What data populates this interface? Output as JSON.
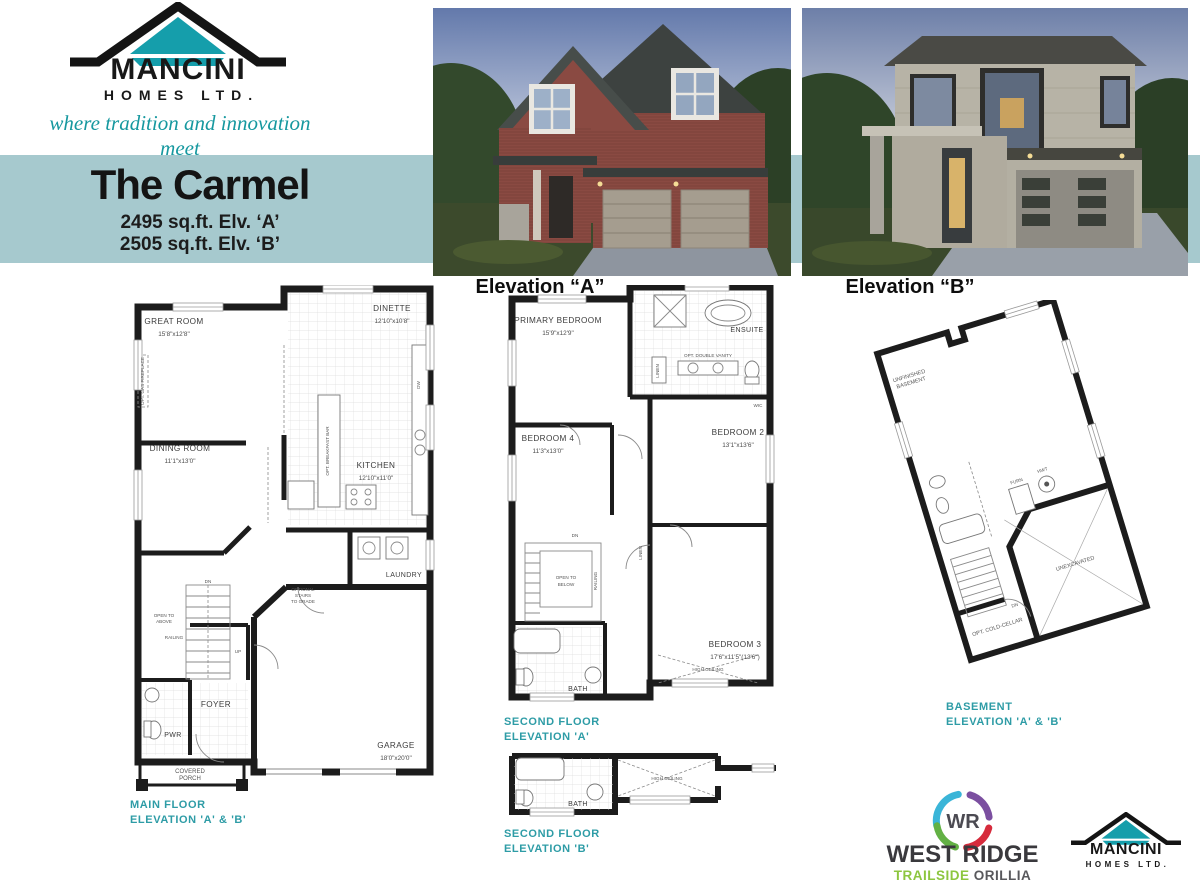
{
  "brand": {
    "name": "MANCINI",
    "suffix": "HOMES LTD.",
    "tagline": "where tradition and innovation meet"
  },
  "colors": {
    "band": "#a6c9ce",
    "accent": "#16989f",
    "caption": "#2e9ca6",
    "logo_teal": "#159eab",
    "wr_cyan": "#3ab5d8",
    "wr_purple": "#7b4fa0",
    "wr_red": "#d62b3c",
    "wr_green": "#63b145",
    "wr_text": "#3a393d",
    "wr_trailside": "#8dc63f",
    "wr_orillia": "#58585c"
  },
  "banner": {
    "title": "The Carmel",
    "spec_a": "2495 sq.ft.  Elv. ‘A’",
    "spec_b": "2505 sq.ft.  Elv. ‘B’"
  },
  "elevations": {
    "a_label": "Elevation “A”",
    "b_label": "Elevation “B”"
  },
  "shared": {
    "dn": "DN",
    "up": "UP",
    "railing": "RAILING",
    "bath": "BATH",
    "linen": "LINEN",
    "high_ceiling": "HIGH CEILING"
  },
  "main_floor": {
    "caption1": "MAIN FLOOR",
    "caption2": "ELEVATION 'A' & 'B'",
    "rooms": {
      "great_room": {
        "name": "GREAT ROOM",
        "dims": "15'8\"x12'8\""
      },
      "dinette": {
        "name": "DINETTE",
        "dims": "12'10\"x10'8\""
      },
      "dining_room": {
        "name": "DINING ROOM",
        "dims": "11'1\"x13'0\""
      },
      "kitchen": {
        "name": "KITCHEN",
        "dims": "12'10\"x11'0\""
      },
      "laundry": {
        "name": "LAUNDRY"
      },
      "foyer": {
        "name": "FOYER"
      },
      "pwr": {
        "name": "PWR"
      },
      "porch1": "COVERED",
      "porch2": "PORCH",
      "garage": {
        "name": "GARAGE",
        "dims": "18'0\"x20'0\""
      }
    },
    "notes": {
      "fireplace": "OPT. GAS FIREPLACE",
      "breakfast_bar": "OPT. BREAKFAST BAR",
      "open_to_above1": "OPEN TO",
      "open_to_above2": "ABOVE",
      "grade1": "OPTIONAL",
      "grade2": "STAIRS",
      "grade3": "TO GRADE",
      "dw": "DW"
    }
  },
  "second_floor_a": {
    "caption1": "SECOND FLOOR",
    "caption2": "ELEVATION 'A'",
    "rooms": {
      "primary": {
        "name": "PRIMARY BEDROOM",
        "dims": "15'9\"x12'9\""
      },
      "ensuite": {
        "name": "ENSUITE"
      },
      "bedroom4": {
        "name": "BEDROOM 4",
        "dims": "11'3\"x13'0\""
      },
      "bedroom2": {
        "name": "BEDROOM 2",
        "dims": "13'1\"x13'6\""
      },
      "bedroom3": {
        "name": "BEDROOM 3",
        "dims": "17'6\"x11'5\"(13'6\")"
      }
    },
    "notes": {
      "vanity": "OPT. DOUBLE VANITY",
      "wic": "WIC",
      "open_below1": "OPEN TO",
      "open_below2": "BELOW"
    }
  },
  "second_floor_b": {
    "caption1": "SECOND FLOOR",
    "caption2": "ELEVATION 'B'"
  },
  "basement": {
    "caption1": "BASEMENT",
    "caption2": "ELEVATION 'A' & 'B'",
    "labels": {
      "unfinished1": "UNFINISHED",
      "unfinished2": "BASEMENT",
      "furn": "FURN",
      "hwt": "HWT",
      "unexcavated": "UNEXCAVATED",
      "cold_cellar": "OPT. COLD-CELLAR"
    }
  },
  "footer": {
    "wr_monogram": "WR",
    "wr_name": "WEST RIDGE",
    "wr_trailside": "TRAILSIDE",
    "wr_orillia": "ORILLIA"
  }
}
